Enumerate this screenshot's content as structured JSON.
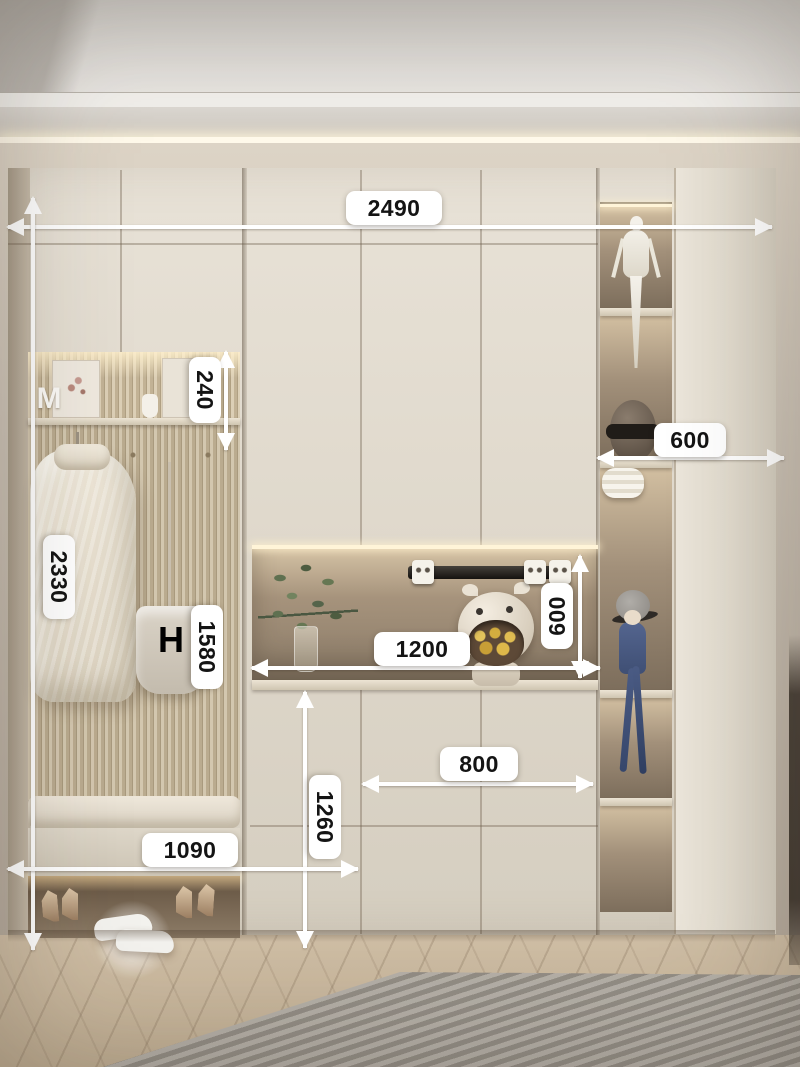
{
  "dimensions": {
    "overall_width": "2490",
    "overall_height": "2330",
    "top_niche_height": "240",
    "cabinet_depth": "600",
    "hanging_panel_height": "1580",
    "counter_niche_width": "1200",
    "counter_niche_height": "600",
    "shoe_cabinet_width": "800",
    "base_cabinet_height": "1260",
    "bench_section_width": "1090"
  },
  "decor_text": {
    "shelf_letter": "M",
    "bag_monogram": "H"
  },
  "colors": {
    "annotation_label_bg": "#ffffff",
    "annotation_text": "#141414",
    "annotation_line": "#ffffff",
    "cabinet_cream": "#e0d9cc",
    "niche_backwall": "#8d7f6d",
    "wall_grey": "#c9c0b4",
    "wood_floor": "#c6b499",
    "rug_grey": "#a9a49b",
    "accent_warm_light": "#ffe9bd"
  }
}
